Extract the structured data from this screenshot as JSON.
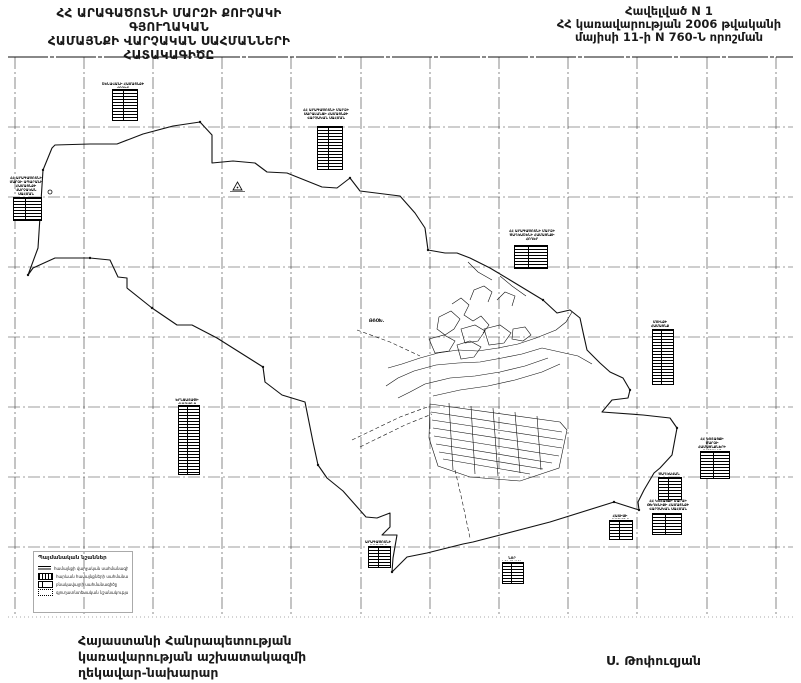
{
  "header": {
    "title_left": {
      "line1": "ՀՀ ԱՐԱԳԱԾՈՏՆԻ ՄԱՐԶԻ ՔՈՒՉԱԿԻ ԳՅՈՒՂԱԿԱՆ",
      "line2": "ՀԱՄԱՅՆՔԻ ՎԱՐՉԱԿԱՆ  ՍԱՀՄԱՆՆԵՐԻ",
      "line3": "ՀԱՏԱԿԱԳԻԾԸ"
    },
    "title_right": {
      "line1": "Հավելված N 1",
      "line2": "ՀՀ կառավարության 2006 թվականի",
      "line3": "մայիսի 11-ի N 760-Ն որոշման"
    }
  },
  "map": {
    "labels": {
      "spot": "ԹՌՕԽ."
    },
    "stamps": [
      {
        "caption": "ՇԵՆԱՎԱՆԻ ՀԱՄԱՅՆՔԻ ՀՈՂԵՐ"
      },
      {
        "caption": "ՀՀ ԱՐԱԳԱԾՈՏՆԻ ՄԱՐԶԻ ԱՊԱՐԱՆԻ ՀԱՄԱՅՆՔԻ ՎԱՐՉԱԿԱՆ ՍԱՀՄԱՆ"
      },
      {
        "caption": "ՀՀ ԱՐԱԳԱԾՈՏՆԻ ՄԱՐԶԻ ՍԱՐԱԼԱՆՋԻ ՀԱՄԱՅՆՔԻ ՎԱՐՉԱԿԱՆ ՍԱՀՄԱՆ"
      },
      {
        "caption": "ՀՀ ԱՐԱԳԱԾՈՏՆԻ ՄԱՐԶԻ ԾԱՂԿԱՇԵՆԻ ՀԱՄԱՅՆՔԻ ՀՈՂԵՐ"
      },
      {
        "caption": "ՄՈՒԼՔԻ ՀԱՄԱՅՆՔ"
      },
      {
        "caption": "ՀՀ ԿՈՏԱՅՔԻ ՄԱՐԶԻ ՀԱՄԱՅՆՔՆԵՐԻ ՎԱՐՉԱԿԱՆ ՍԱՀՄԱՆ"
      },
      {
        "caption": "ԾԱՂԿԱՎԱՆ"
      },
      {
        "caption": "ՀՀ ԿՈՏԱՅՔԻ ՄԱՐԶԻ ԹԵՂԵՆԻՔԻ ՀԱՄԱՅՆՔԻ ՎԱՐՉԱԿԱՆ ՍԱՀՄԱՆ"
      },
      {
        "caption": "ՀԱՏԻՍԻ ՀԱՄԱՅՆՔ"
      },
      {
        "caption": "ԵՐՆՋԱՏԱՓԻ ՀԱՄԱՅՆՔ"
      },
      {
        "caption": "ԱՐԱԳԱԾՈՏՆԻ ՀԱՄԱՅՆՔ"
      },
      {
        "caption": "ՆՈՐ ԵԴԵՍԻԱՅԻ ՀՈՂԵՐ"
      }
    ]
  },
  "legend": {
    "title": "Պայմանական նշաններ",
    "items": [
      {
        "label": "համայնքի վարչական սահմանագիծը"
      },
      {
        "label": "հարևան համայնքների սահմանագծերը"
      },
      {
        "label": "բնակավայրի սահմանագիծը"
      },
      {
        "label": "գյուղատնտեսական նշանակության հողեր"
      }
    ]
  },
  "footer": {
    "left": [
      "Հայաստանի Հանրապետության",
      "կառավարության աշխատակազմի",
      "ղեկավար-նախարար"
    ],
    "signature": "Ս. Թոփուզյան"
  },
  "colors": {
    "ink": "#1a1a1a",
    "grid": "#3a3a3a"
  }
}
